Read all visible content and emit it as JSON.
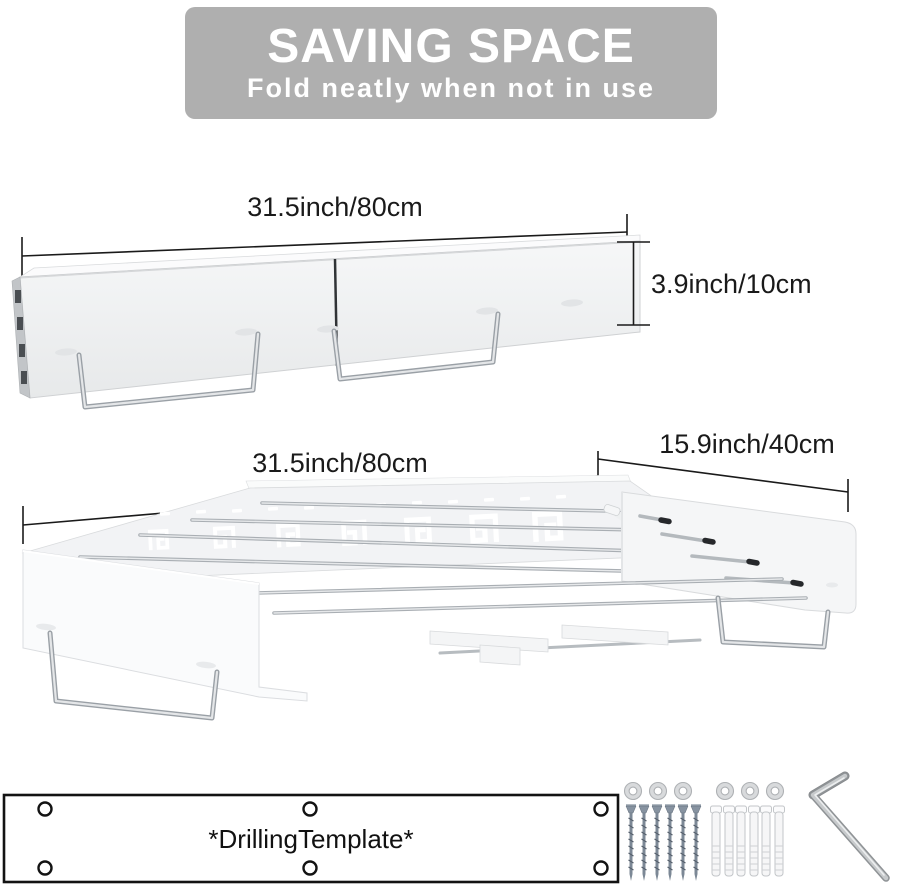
{
  "banner": {
    "title": "SAVING SPACE",
    "subtitle": "Fold neatly when not in use",
    "bg_color": "#afafaf",
    "text_color": "#ffffff"
  },
  "folded_view": {
    "description": "drying rack folded flat against wall",
    "width_label": "31.5inch/80cm",
    "height_label": "3.9inch/10cm"
  },
  "unfolded_view": {
    "description": "drying rack unfolded with rods extended",
    "width_label": "31.5inch/80cm",
    "depth_label": "15.9inch/40cm"
  },
  "accessories": {
    "template_label": "*DrillingTemplate*",
    "icons": [
      "drilling-template",
      "washer-rings",
      "mounting-screws",
      "wall-anchors",
      "allen-wrench"
    ],
    "counts": {
      "template_holes": 6,
      "rings": 6,
      "screws": 6,
      "anchors": 6,
      "wrench": 1
    }
  },
  "colors": {
    "banner_bg": "#afafaf",
    "banner_text": "#ffffff",
    "dimension_line": "#1a1a1a",
    "rack_body": "#f3f4f5",
    "metal_rod": "#a9aeb3",
    "screw_steel": "#7c8896",
    "rod_tip": "#26282b"
  }
}
